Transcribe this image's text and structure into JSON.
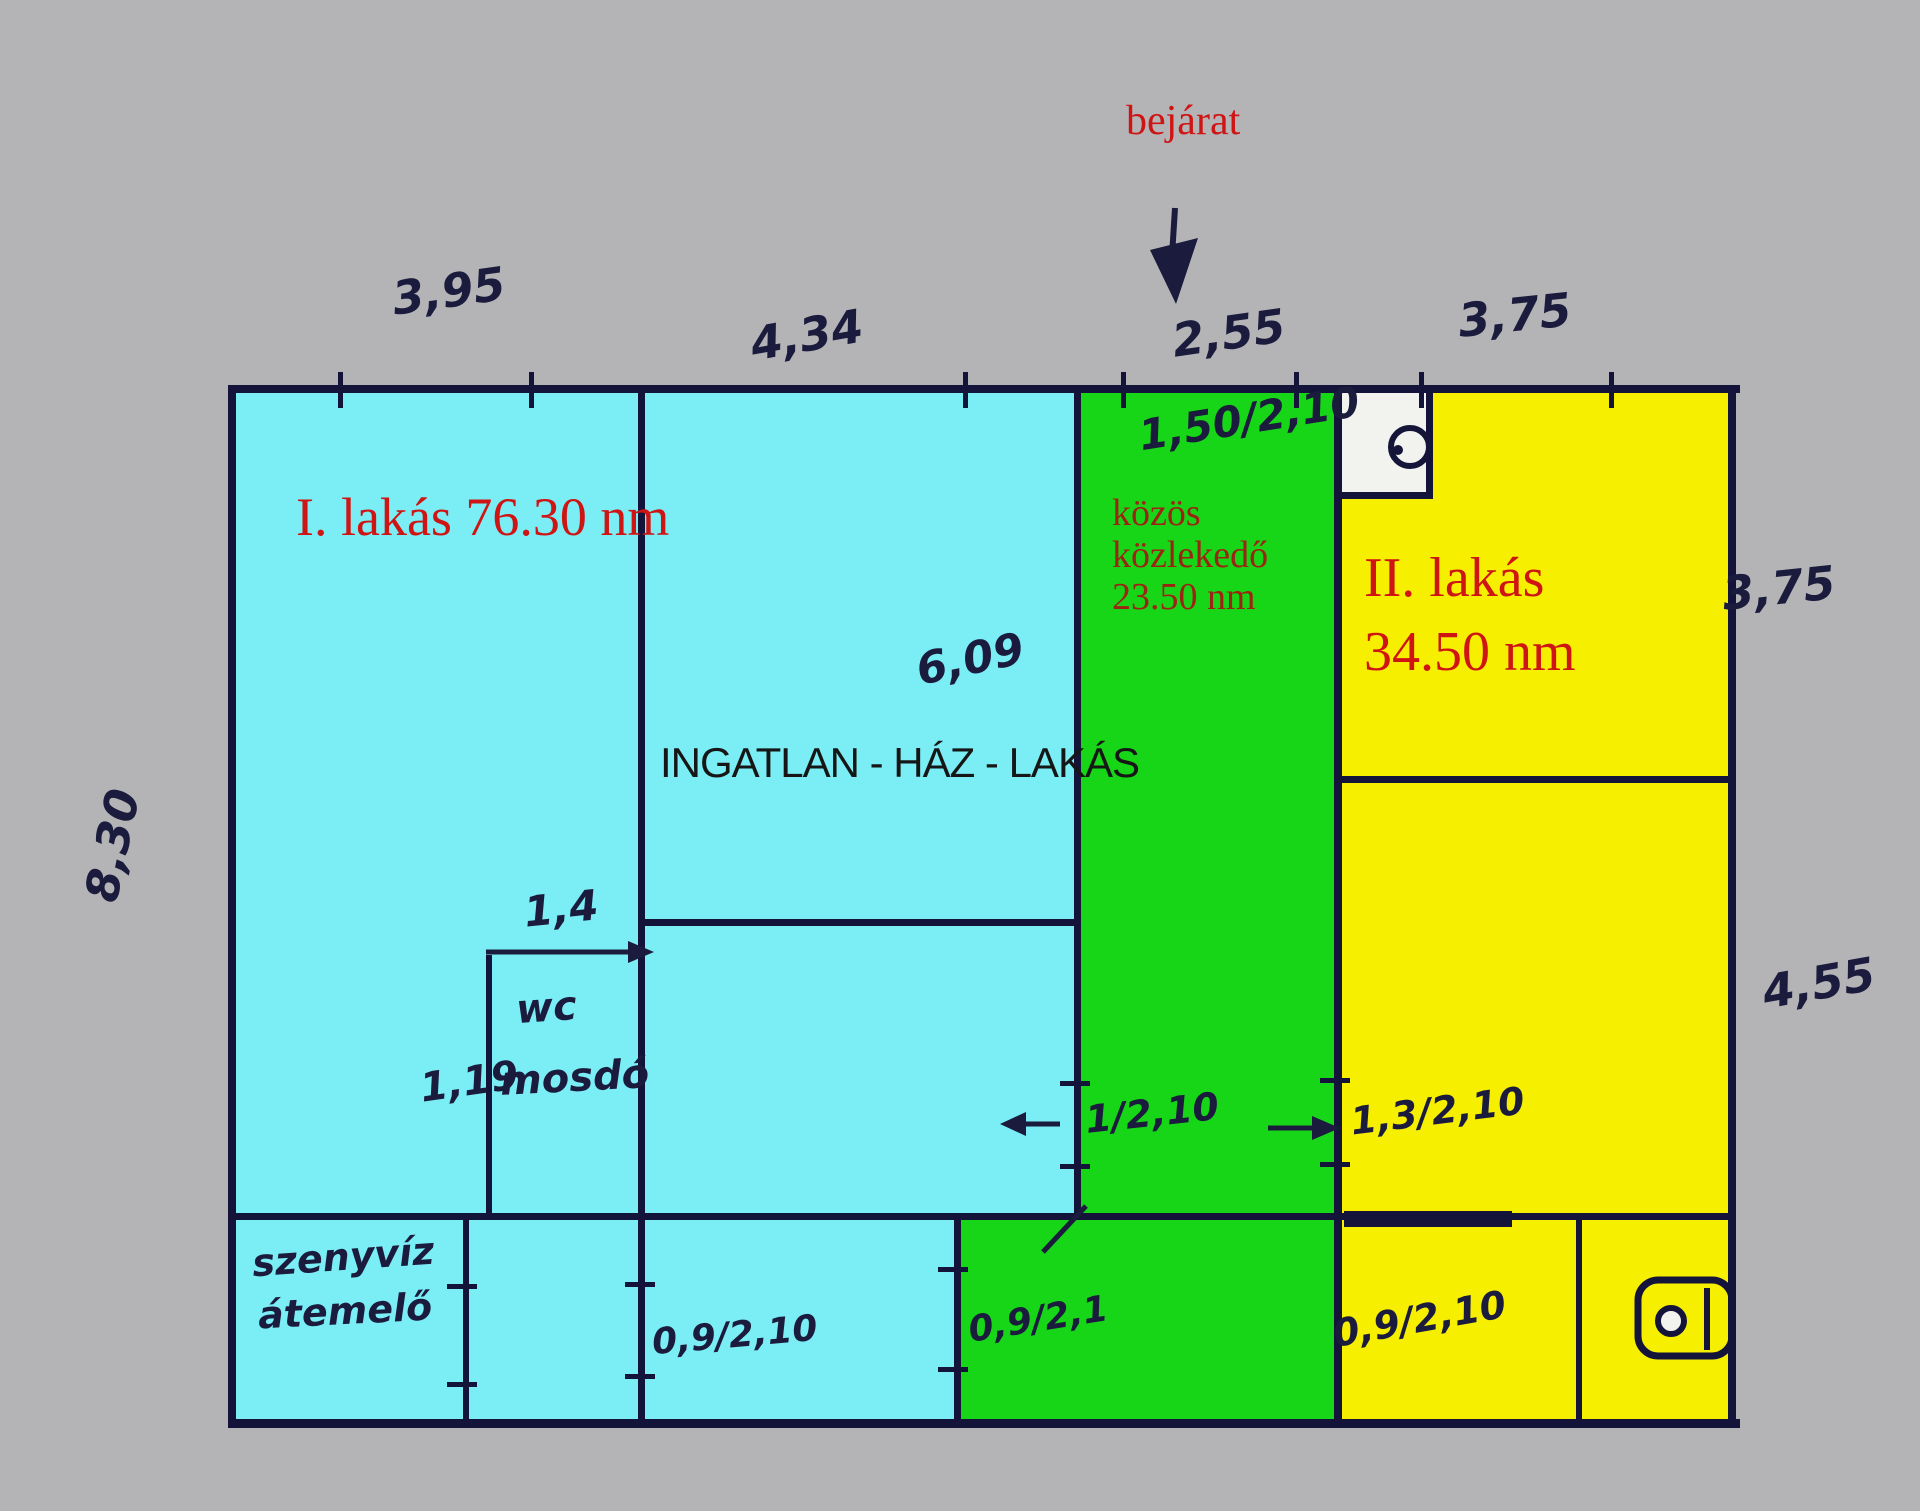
{
  "image": {
    "kind": "hand-drawn floor plan sketch",
    "width": 1920,
    "height": 1511
  },
  "colors": {
    "background": "#b4b4b6",
    "apartment1_fill": "#7aedf5",
    "corridor_fill": "#17d617",
    "apartment2_fill": "#f6ef00",
    "walls_ink": "#14143a",
    "red_label": "#cf1414",
    "dark_red_label": "#9c2412",
    "handwriting_ink": "#1b1b3d",
    "watermark": "#161616"
  },
  "entrance": {
    "label": "bejárat"
  },
  "watermark": {
    "text": "INGATLAN - HÁZ - LAKÁS"
  },
  "apartment1": {
    "label": "I. lakás 76.30 nm"
  },
  "corridor": {
    "line1": "közös",
    "line2": "közlekedő",
    "line3": "23.50 nm"
  },
  "apartment2": {
    "line1": "II. lakás",
    "line2": "34.50 nm"
  },
  "dims": {
    "top": [
      "3,95",
      "4,34",
      "2,55",
      "3,75"
    ],
    "right": [
      "3,75",
      "4,55"
    ],
    "left": [
      "8,30"
    ],
    "room_height": "6,09"
  },
  "wc": {
    "width": "1,4",
    "label": "wc",
    "label2": "mosdó",
    "depth": "1,19"
  },
  "pump": {
    "line1": "szenyvíz",
    "line2": "átemelő"
  },
  "doors": {
    "entrance": "1,50/2,10",
    "left": "1/2,10",
    "right": "1,3/2,10",
    "bottom_left": "0,9/2,10",
    "bottom_middle": "0,9/2,1",
    "bottom_right": "0,9/2,10"
  }
}
